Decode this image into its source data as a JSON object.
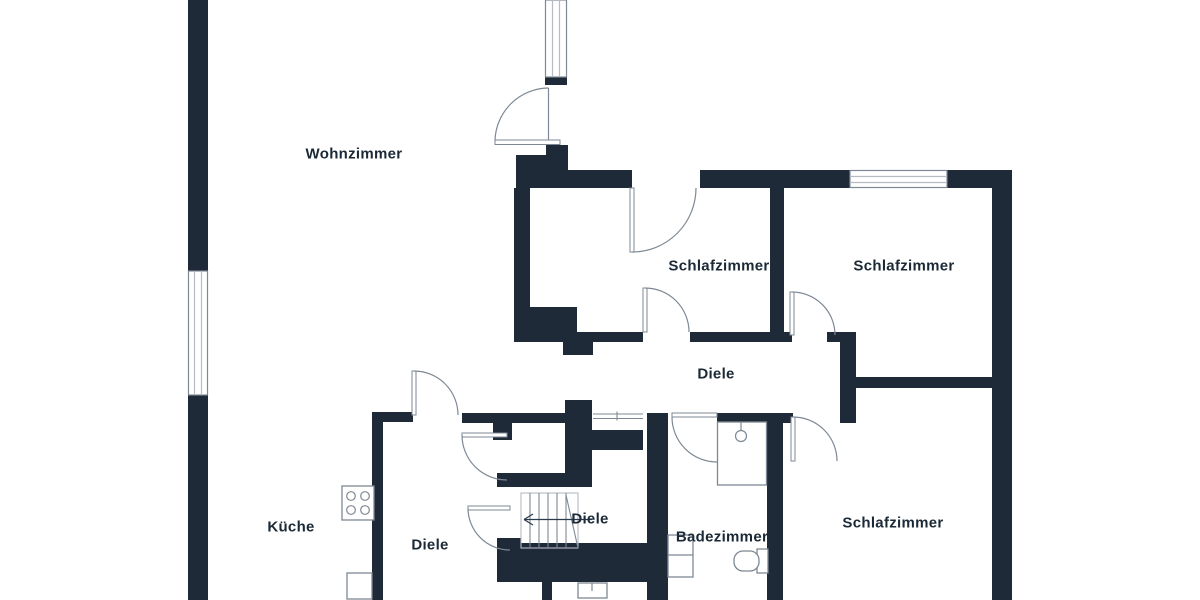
{
  "floorplan": {
    "title": "apartment-floor-plan",
    "rooms": [
      {
        "id": "wohnzimmer",
        "label": "Wohnzimmer"
      },
      {
        "id": "schlafzimmer-mitte",
        "label": "Schlafzimmer"
      },
      {
        "id": "schlafzimmer-rechts-oben",
        "label": "Schlafzimmer"
      },
      {
        "id": "diele-flur",
        "label": "Diele"
      },
      {
        "id": "schlafzimmer-rechts-unten",
        "label": "Schlafzimmer"
      },
      {
        "id": "badezimmer",
        "label": "Badezimmer"
      },
      {
        "id": "diele-treppe",
        "label": "Diele"
      },
      {
        "id": "diele-unten-links",
        "label": "Diele"
      },
      {
        "id": "kueche",
        "label": "Küche"
      }
    ],
    "fixtures": [
      "stove-icon-4-burners",
      "shower-icon",
      "washbasin-icon",
      "toilet-icon",
      "staircase-with-direction-arrow",
      "door-swing-arcs",
      "window-symbols"
    ],
    "colors": {
      "wall": "#1e2a37",
      "line": "#7e8894",
      "line-light": "#b5bcc4",
      "text": "#1b2936",
      "bg": "#ffffff"
    }
  }
}
